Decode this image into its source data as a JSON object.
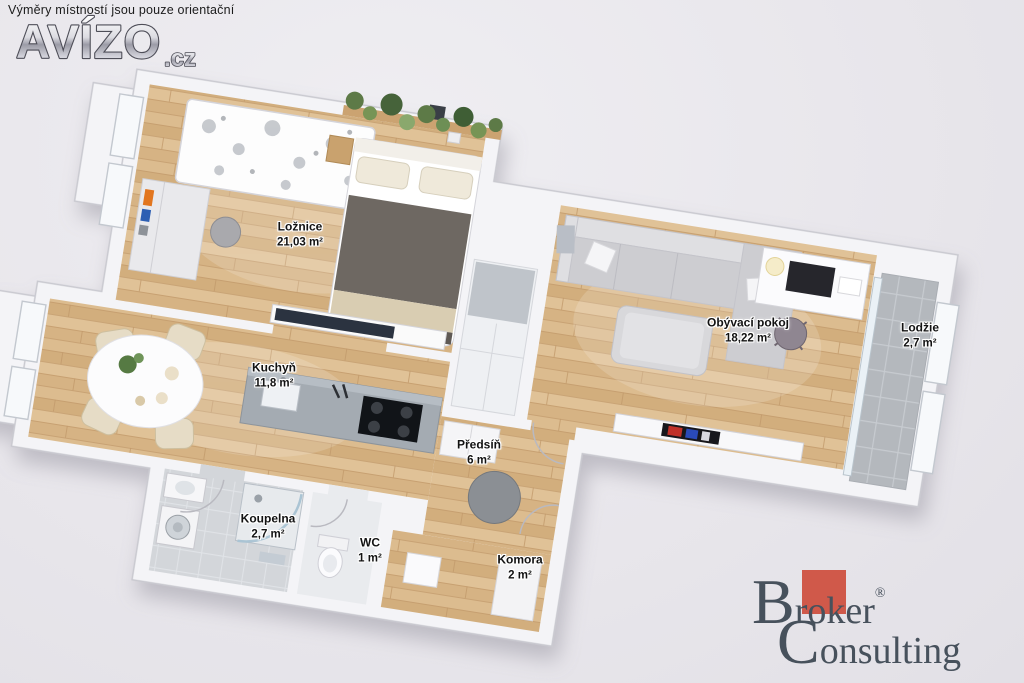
{
  "header": {
    "disclaimer": "Výměry místností jsou pouze orientační",
    "logo": {
      "text": "AVÍZO",
      "suffix": ".cz"
    }
  },
  "rooms": [
    {
      "id": "loznice",
      "name": "Ložnice",
      "area": "21,03 m²"
    },
    {
      "id": "obyvaci-pokoj",
      "name": "Obývací pokoj",
      "area": "18,22 m²"
    },
    {
      "id": "lodzie",
      "name": "Lodžie",
      "area": "2,7 m²"
    },
    {
      "id": "kuchyn",
      "name": "Kuchyň",
      "area": "11,8 m²"
    },
    {
      "id": "predsin",
      "name": "Předsíň",
      "area": "6 m²"
    },
    {
      "id": "koupelna",
      "name": "Koupelna",
      "area": "2,7 m²"
    },
    {
      "id": "wc",
      "name": "WC",
      "area": "1 m²"
    },
    {
      "id": "komora",
      "name": "Komora",
      "area": "2 m²"
    }
  ],
  "footer_logo": {
    "cap1": "B",
    "rest1": "roker",
    "registered": "®",
    "cap2": "C",
    "rest2": "onsulting"
  },
  "colors": {
    "background": "#e8e6eb",
    "wood_floor": "#d9b88b",
    "loggia_tile": "#b4b8bd",
    "bath_tile": "#d3d6da",
    "wall": "#f4f4f7",
    "label_text": "#121212",
    "logo_red": "#d0594a",
    "logo_text": "#47515c"
  }
}
